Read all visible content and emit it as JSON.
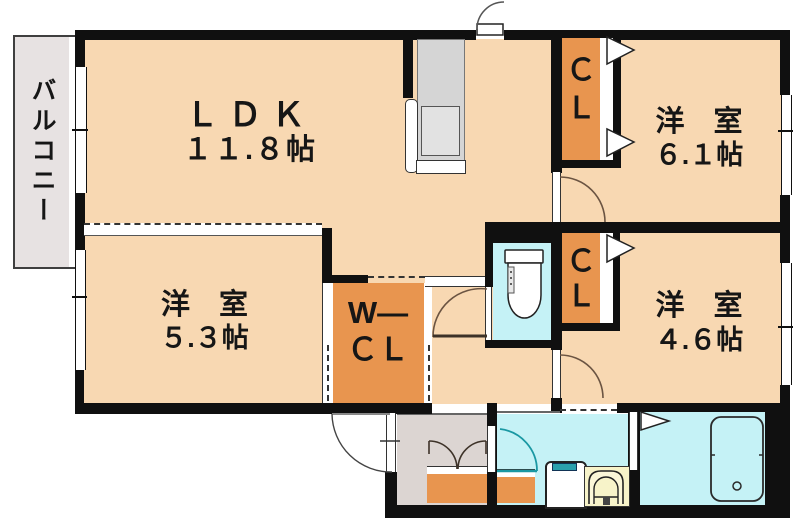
{
  "balcony": {
    "label": "バルコニー"
  },
  "rooms": {
    "ldk": {
      "name": "ＬＤＫ",
      "size": "１１.８帖"
    },
    "bedroom_top_right": {
      "name": "洋　室",
      "size": "６.１帖"
    },
    "bedroom_bottom_left": {
      "name": "洋　室",
      "size": "５.３帖"
    },
    "bedroom_bottom_right": {
      "name": "洋　室",
      "size": "４.６帖"
    }
  },
  "closets": {
    "closet_top": {
      "line1": "Ｃ",
      "line2": "Ｌ"
    },
    "closet_middle": {
      "line1": "Ｃ",
      "line2": "Ｌ"
    },
    "walk_in_closet": {
      "line1": "W―",
      "line2": "ＣＬ"
    }
  },
  "colors": {
    "room_floor": "#F8D8B2",
    "closet": "#E8954F",
    "wet_area": "#C5F2F6",
    "entry_floor": "#DCD5D2",
    "wall": "#101010",
    "washbasin": "#F7F3C9",
    "door_arc_teal": "#1A98A3"
  }
}
